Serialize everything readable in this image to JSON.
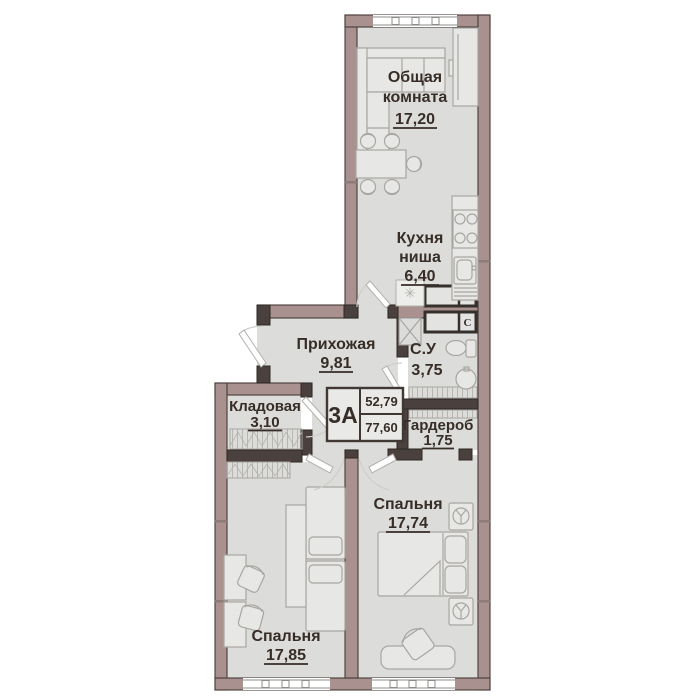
{
  "plan": {
    "stamp": {
      "unit": "3А",
      "area_top": "52,79",
      "area_bottom": "77,60"
    },
    "rooms": {
      "living": {
        "line1": "Общая",
        "line2": "комната",
        "area": "17,20"
      },
      "kitchen": {
        "line1": "Кухня",
        "line2": "ниша",
        "area": "6,40"
      },
      "hall": {
        "name": "Прихожая",
        "area": "9,81"
      },
      "bath": {
        "name": "С.У",
        "area": "3,75"
      },
      "storage": {
        "name": "Кладовая",
        "area": "3,10"
      },
      "wardrobe": {
        "name": "Гардероб",
        "area": "1,75"
      },
      "bedroom_right": {
        "name": "Спальня",
        "area": "17,74"
      },
      "bedroom_left": {
        "name": "Спальня",
        "area": "17,85"
      }
    },
    "symbols": {
      "vent": "C",
      "washer": "✳"
    },
    "colors": {
      "wall": "#a8918e",
      "wall_dark": "#4a403d",
      "floor": "#dcdcda",
      "furniture_line": "#a8a6a2",
      "text": "#372d27",
      "background": "#ffffff"
    }
  }
}
